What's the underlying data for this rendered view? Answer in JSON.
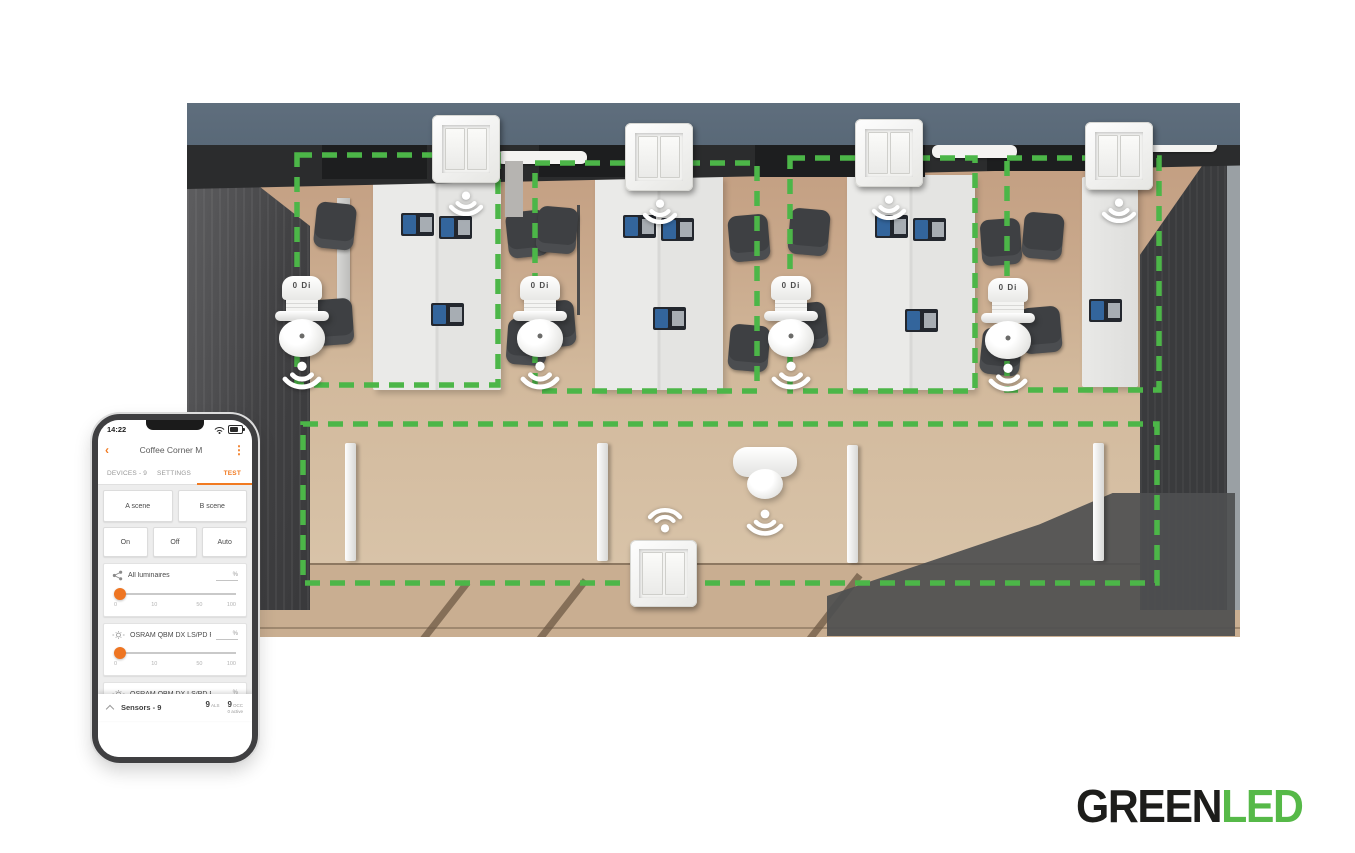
{
  "phone": {
    "status_time": "14:22",
    "header": {
      "back_icon": "‹",
      "title": "Coffee Corner M",
      "menu_icon": "⋮"
    },
    "tabs": {
      "devices": "DEVICES - 9",
      "settings": "SETTINGS",
      "test": "TEST"
    },
    "buttons": {
      "a_scene": "A scene",
      "b_scene": "B scene",
      "on": "On",
      "off": "Off",
      "auto": "Auto"
    },
    "percent": "%",
    "ticks": [
      "0",
      "10",
      "50",
      "100"
    ],
    "sliders": [
      {
        "name": "All luminaires",
        "value": 0
      },
      {
        "name": "OSRAM QBM DX LS/PD R 8e…",
        "value": 0
      },
      {
        "name": "OSRAM QBM DX LS/PD R eb…",
        "value": 0
      }
    ],
    "sensors_bar": {
      "title": "Sensors - 9",
      "als_value": "9",
      "als_unit": "ALS",
      "occ_value": "9",
      "occ_unit": "OCC",
      "occ_note": "0 active"
    }
  },
  "scene": {
    "sensor_device_label": "0 Di",
    "zone_count": 5,
    "zone_color": "#4cb648"
  },
  "logo": {
    "part_black": "GREEN",
    "part_green": "LED"
  },
  "colors": {
    "accent_orange": "#F17A21",
    "zone_green": "#4CB648",
    "logo_green": "#56B948"
  }
}
